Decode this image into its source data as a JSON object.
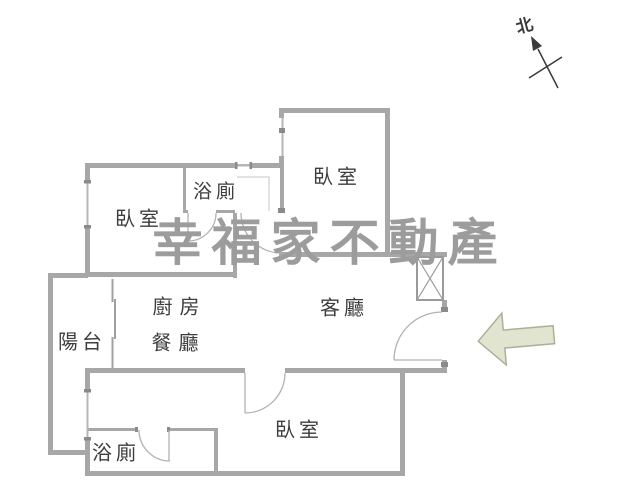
{
  "compass": {
    "label": "北"
  },
  "watermark": {
    "text": "幸福家不動產"
  },
  "rooms": {
    "bedroom_top_left": {
      "label": "臥室"
    },
    "bathroom_top": {
      "label": "浴廁"
    },
    "bedroom_top_right": {
      "label": "臥室"
    },
    "kitchen": {
      "label": "廚房"
    },
    "dining": {
      "label": "餐廳"
    },
    "living": {
      "label": "客廳"
    },
    "balcony": {
      "label": "陽台"
    },
    "bedroom_bottom": {
      "label": "臥室"
    },
    "bathroom_bottom": {
      "label": "浴廁"
    }
  },
  "entrance_arrow": {
    "direction": "left"
  },
  "colors": {
    "wall": "#a7a7a7",
    "wall_light": "#b6b6b6",
    "jamb": "#8a8a8a",
    "arc": "#b2b2b2",
    "label_text": "#3d3d3d",
    "watermark": "#9c9c9c",
    "arrow_fill": "#e1e4cf",
    "arrow_border": "#acb098",
    "compass": "#3a3a3a"
  }
}
